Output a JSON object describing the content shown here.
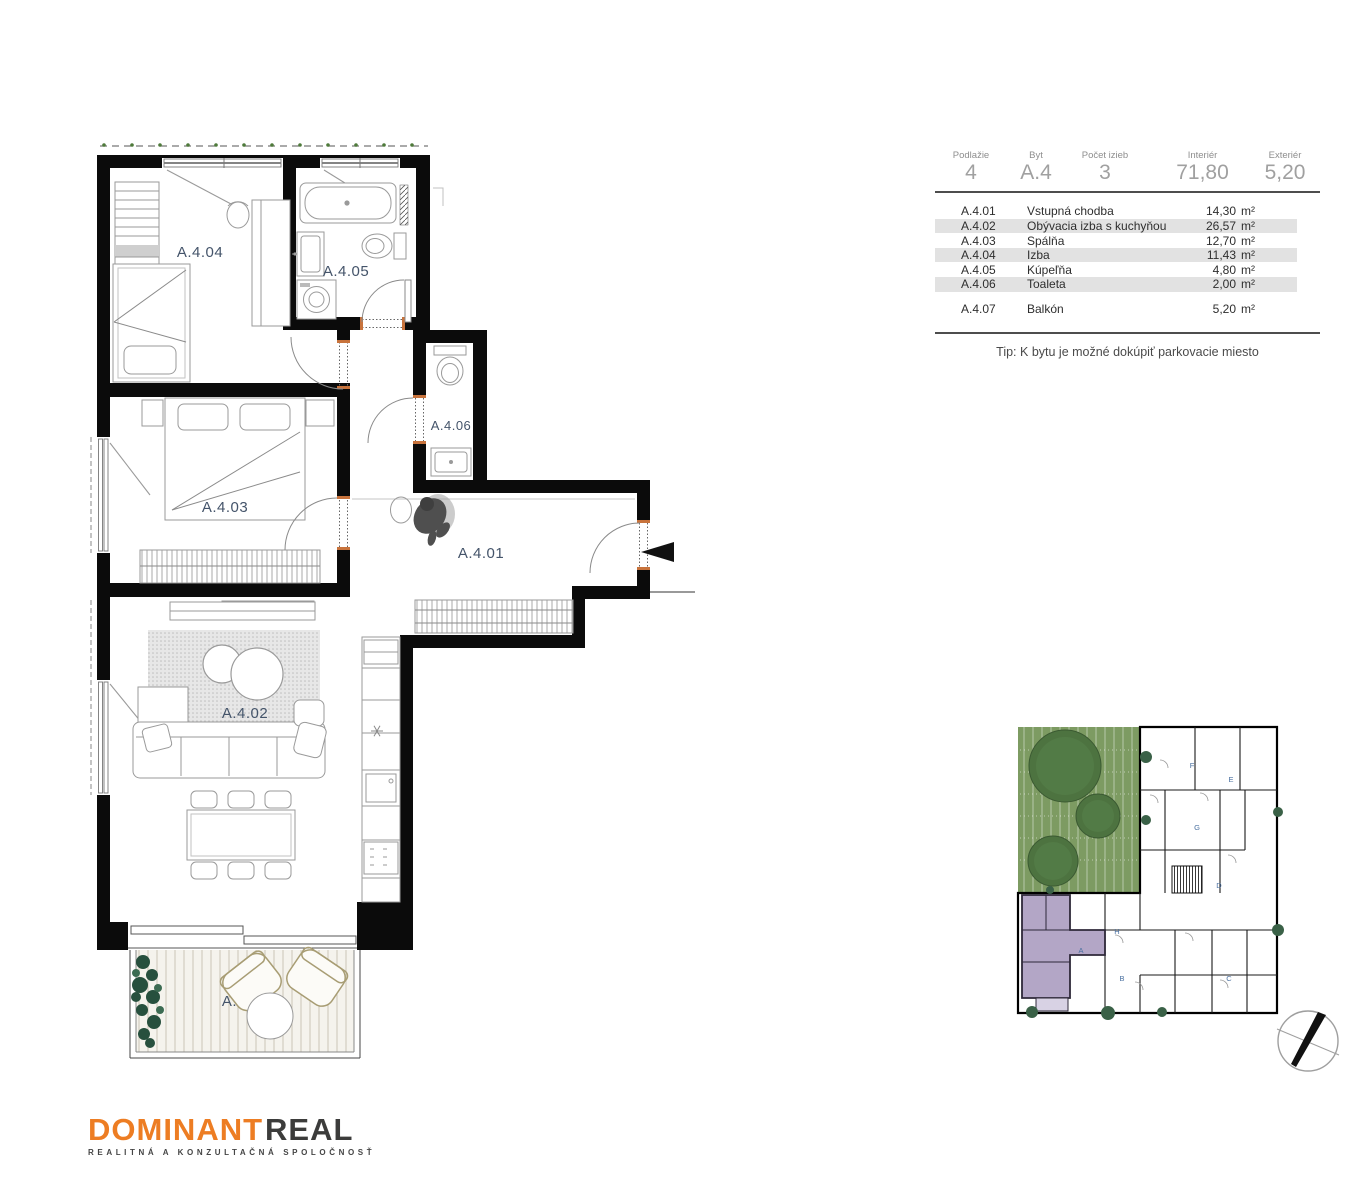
{
  "summary": {
    "columns": [
      {
        "label": "Podlažie",
        "value": "4"
      },
      {
        "label": "Byt",
        "value": "A.4"
      },
      {
        "label": "Počet izieb",
        "value": "3"
      },
      {
        "label": "Interiér",
        "value": "71,80"
      },
      {
        "label": "Exteriér",
        "value": "5,20"
      }
    ]
  },
  "rooms_table": {
    "rows": [
      {
        "code": "A.4.01",
        "name": "Vstupná chodba",
        "area": "14,30",
        "unit": "m²",
        "shaded": false
      },
      {
        "code": "A.4.02",
        "name": "Obývacia izba s kuchyňou",
        "area": "26,57",
        "unit": "m²",
        "shaded": true
      },
      {
        "code": "A.4.03",
        "name": "Spálňa",
        "area": "12,70",
        "unit": "m²",
        "shaded": false
      },
      {
        "code": "A.4.04",
        "name": "Izba",
        "area": "11,43",
        "unit": "m²",
        "shaded": true
      },
      {
        "code": "A.4.05",
        "name": "Kúpeľňa",
        "area": "4,80",
        "unit": "m²",
        "shaded": false
      },
      {
        "code": "A.4.06",
        "name": "Toaleta",
        "area": "2,00",
        "unit": "m²",
        "shaded": true
      },
      {
        "code": "A.4.07",
        "name": "Balkón",
        "area": "5,20",
        "unit": "m²",
        "shaded": false
      }
    ],
    "tip": "Tip:  K bytu je možné dokúpiť parkovacie miesto"
  },
  "floorplan": {
    "labels": {
      "a401": "A.4.01",
      "a402": "A.4.02",
      "a403": "A.4.03",
      "a404": "A.4.04",
      "a405": "A.4.05",
      "a406": "A.4.06",
      "a407": "A.4.07"
    }
  },
  "siteplan": {
    "units": {
      "a": "A",
      "b": "B",
      "c": "C",
      "d": "D",
      "e": "E",
      "f": "F",
      "g": "G",
      "h": "H"
    }
  },
  "logo": {
    "brand_primary": "DOMINANT",
    "brand_secondary": "REAL",
    "tagline": "REALITNÁ A KONZULTAČNÁ SPOLOČNOSŤ"
  },
  "colors": {
    "accent_orange": "#ED7D23",
    "label_blue": "#44546A",
    "lawn_green": "#7D9B62",
    "tree_green": "#4D7340",
    "unit_purple": "#B3A6C6",
    "row_shade": "#E2E2E2"
  }
}
